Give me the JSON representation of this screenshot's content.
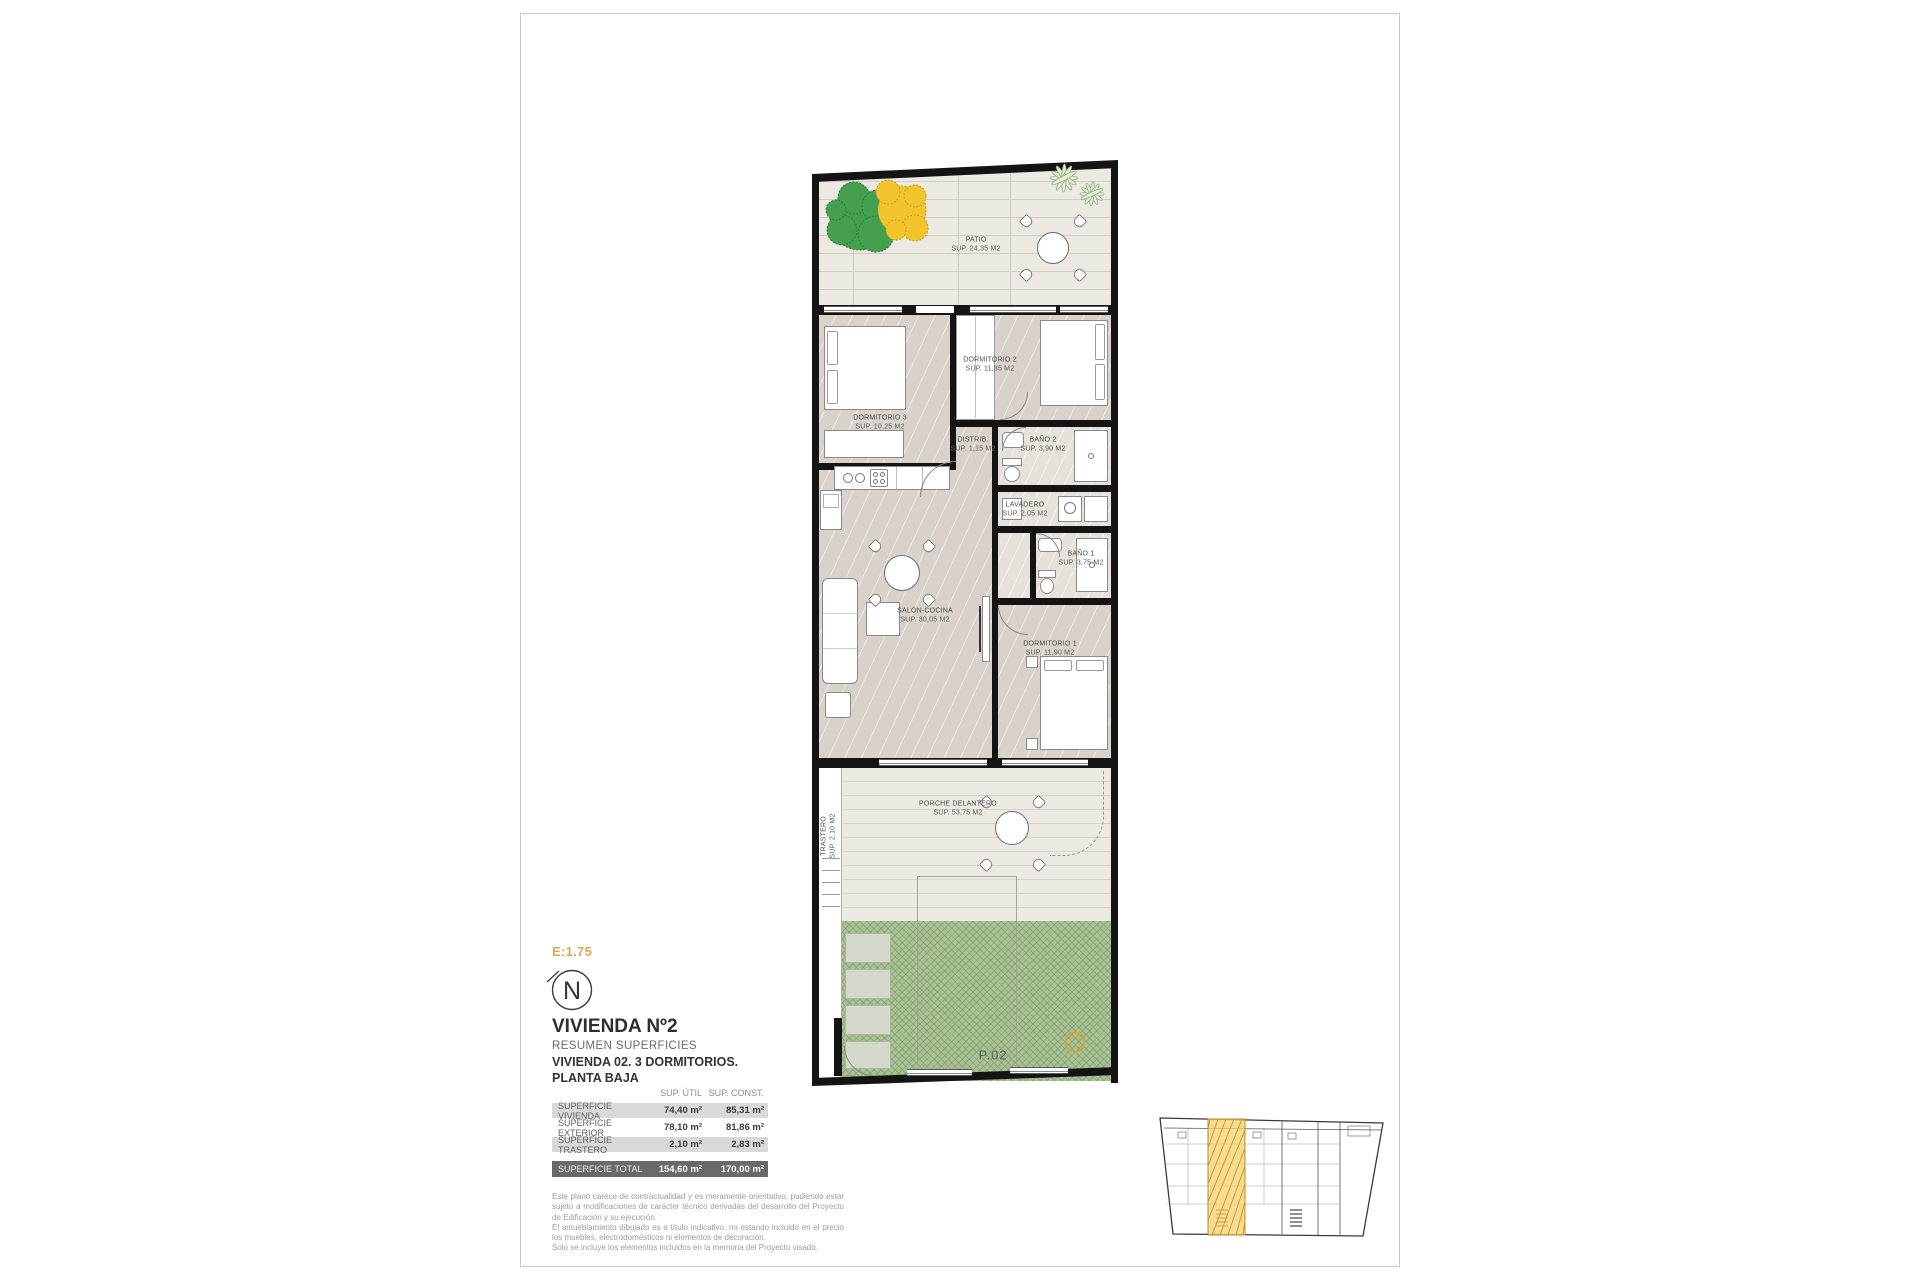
{
  "header": {
    "scale_label": "E:1.75",
    "north_label": "N",
    "title": "VIVIENDA Nº2",
    "subtitle": "RESUMEN SUPERFICIES",
    "line1": "VIVIENDA 02. 3 DORMITORIOS.",
    "line2": "PLANTA BAJA"
  },
  "rooms": [
    {
      "name": "PATIO",
      "sup": "SUP. 24,35 M2"
    },
    {
      "name": "DORMITORIO 2",
      "sup": "SUP. 11,35 M2"
    },
    {
      "name": "DORMITORIO 3",
      "sup": "SUP. 10,25 M2"
    },
    {
      "name": "DISTRIB.",
      "sup": "SUP. 1,15 M2"
    },
    {
      "name": "BAÑO 2",
      "sup": "SUP. 3,90 M2"
    },
    {
      "name": "LAVADERO",
      "sup": "SUP. 2,05 M2"
    },
    {
      "name": "BAÑO 1",
      "sup": "SUP. 3,75 M2"
    },
    {
      "name": "SALÓN-COCINA",
      "sup": "SUP. 30,05 M2"
    },
    {
      "name": "DORMITORIO 1",
      "sup": "SUP. 11,90 M2"
    },
    {
      "name": "PORCHE DELANTERO",
      "sup": "SUP. 53,75 M2"
    },
    {
      "name": "TRASTERO",
      "sup": "SUP. 2,10 M2"
    }
  ],
  "garden": {
    "plot_label": "P.02"
  },
  "table": {
    "col_headers": [
      "SUP. ÚTIL",
      "SUP. CONST."
    ],
    "rows": [
      {
        "label": "SUPERFICIE VIVIENDA",
        "util": "74,40 m²",
        "const": "85,31 m²"
      },
      {
        "label": "SUPERFICIE EXTERIOR",
        "util": "78,10 m²",
        "const": "81,86 m²"
      },
      {
        "label": "SUPERFICIE TRASTERO",
        "util": "2,10 m²",
        "const": "2,83 m²"
      }
    ],
    "total": {
      "label": "SUPERFICIE TOTAL",
      "util": "154,60 m²",
      "const": "170,00 m²"
    }
  },
  "disclaimer": {
    "p1": "Este plano carece de contractualidad y es meramente orientativo, pudiendo estar sujeto a modificaciones de carácter técnico derivadas del desarrollo del Proyecto de Edificación y su ejecución.",
    "p2": "El amueblamiento dibujado es a título indicativo, no estando incluido en el precio los muebles, electrodomésticos ni elementos de decoración.",
    "p3": "Solo se incluye los elementos incluidos en la memoria del Proyecto visado."
  },
  "colors": {
    "accent_gold": "#D9A94A",
    "wall_black": "#141414",
    "garden_green": "#A9C295",
    "patio_beige": "#ECE8E2",
    "floor_beige": "#D8D2CA",
    "highlight_yellow": "#F5D06E",
    "total_row_gray": "#696969",
    "row_gray": "#D9D9D9",
    "tree_green": "#44A04F",
    "tree_yellow": "#F2C52D"
  }
}
